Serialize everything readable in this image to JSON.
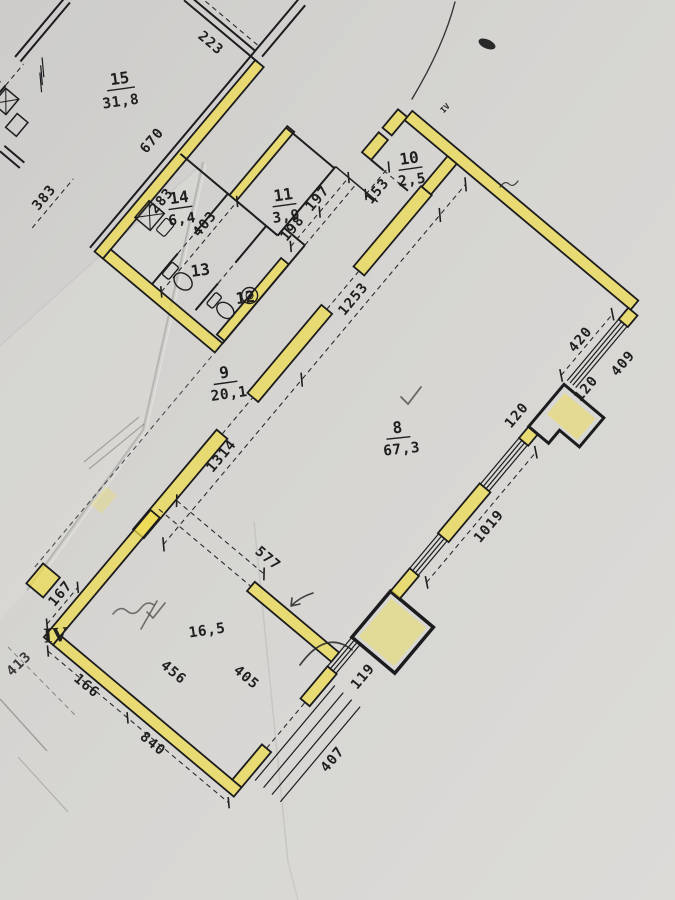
{
  "colors": {
    "paper": "#d3d2d0",
    "wall_ink": "#1c1c1e",
    "highlighter": "#f0dd4e",
    "pencil": "#55534e"
  },
  "rooms": {
    "r15": {
      "num": "15",
      "area": "31,8"
    },
    "r14": {
      "num": "14",
      "area": "6,4"
    },
    "r13": {
      "num": "13"
    },
    "r12": {
      "num": "12"
    },
    "r11": {
      "num": "11",
      "area": "3,9"
    },
    "r10": {
      "num": "10",
      "area": "2,5"
    },
    "r9": {
      "num": "9",
      "area": "20,1"
    },
    "r8": {
      "num": "8",
      "area": "67,3"
    },
    "r16": {
      "area": "16,5"
    }
  },
  "marks": {
    "entrance": "IV",
    "corner": "IV"
  },
  "dims": {
    "d223": "223",
    "d670": "670",
    "d383": "383",
    "d283": "283",
    "d403": "403",
    "d198": "198",
    "d197": "197",
    "d153": "153",
    "d1314": "1314",
    "d1253": "1253",
    "d420": "420",
    "d409": "409",
    "d120a": "120",
    "d120b": "120",
    "d1019": "1019",
    "d577": "577",
    "d119": "119",
    "d405": "405",
    "d407": "407",
    "d456": "456",
    "d166": "166",
    "d840": "840",
    "d167": "167",
    "d413": "413"
  }
}
